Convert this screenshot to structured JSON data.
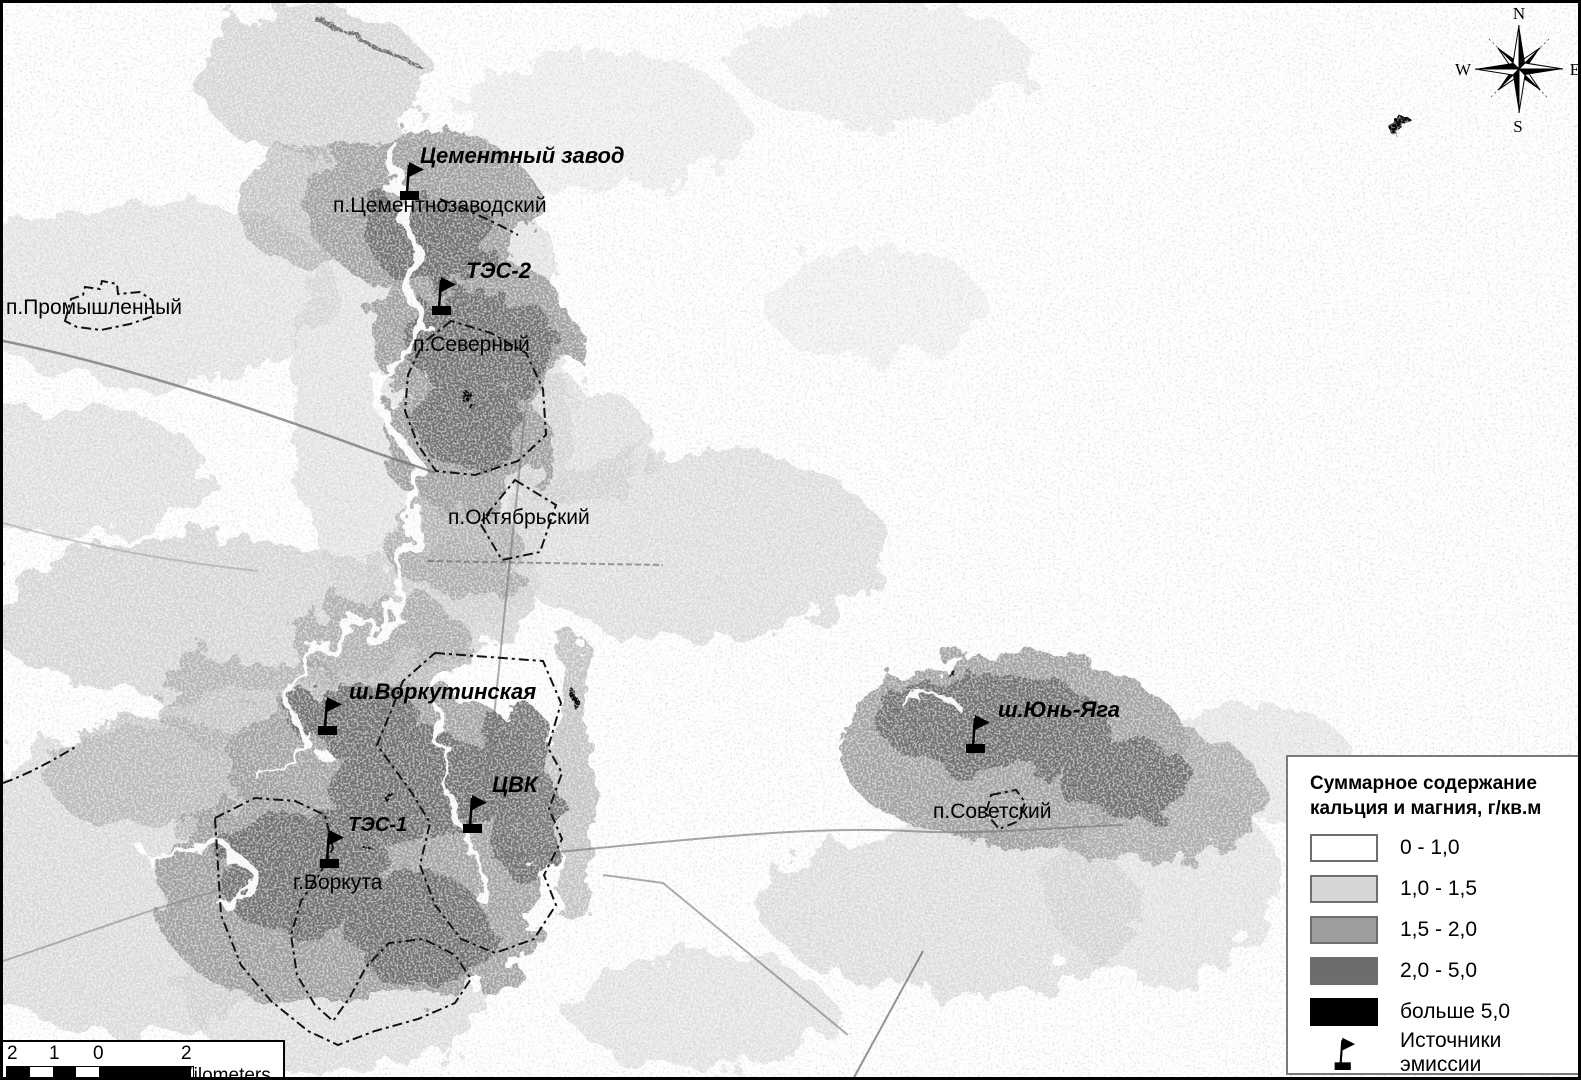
{
  "map": {
    "emission_sources": [
      {
        "id": "cement-plant",
        "label": "Цементный завод"
      },
      {
        "id": "tes-2",
        "label": "ТЭС-2"
      },
      {
        "id": "vorkutinskaya",
        "label": "ш.Воркутинская"
      },
      {
        "id": "cvk",
        "label": "ЦВК"
      },
      {
        "id": "tes-1",
        "label": "ТЭС-1"
      },
      {
        "id": "yun-yaga",
        "label": "ш.Юнь-Яга"
      }
    ],
    "settlements": [
      {
        "id": "cementnozavodsky",
        "label": "п.Цементнозаводский"
      },
      {
        "id": "promyshlenny",
        "label": "п.Промышленный"
      },
      {
        "id": "severny",
        "label": "п.Северный"
      },
      {
        "id": "oktyabrsky",
        "label": "п.Октябрьский"
      },
      {
        "id": "vorkuta",
        "label": "г.Воркута"
      },
      {
        "id": "sovetsky",
        "label": "п.Советский"
      }
    ]
  },
  "legend": {
    "title_line1": "Суммарное содержание",
    "title_line2": "кальция и магния, г/кв.м",
    "classes": [
      {
        "label": "0 - 1,0",
        "color": "#ffffff"
      },
      {
        "label": "1,0 - 1,5",
        "color": "#d6d6d6"
      },
      {
        "label": "1,5 - 2,0",
        "color": "#9e9e9e"
      },
      {
        "label": "2,0 - 5,0",
        "color": "#6d6d6d"
      },
      {
        "label": "больше 5,0",
        "color": "#000000"
      }
    ],
    "emission_label": "Источники эмиссии"
  },
  "scale_bar": {
    "tick_labels": [
      "2",
      "1",
      "0"
    ],
    "end_label": "2 Kilometers"
  },
  "compass": {
    "north": "N",
    "east": "E",
    "south": "S",
    "west": "W"
  }
}
